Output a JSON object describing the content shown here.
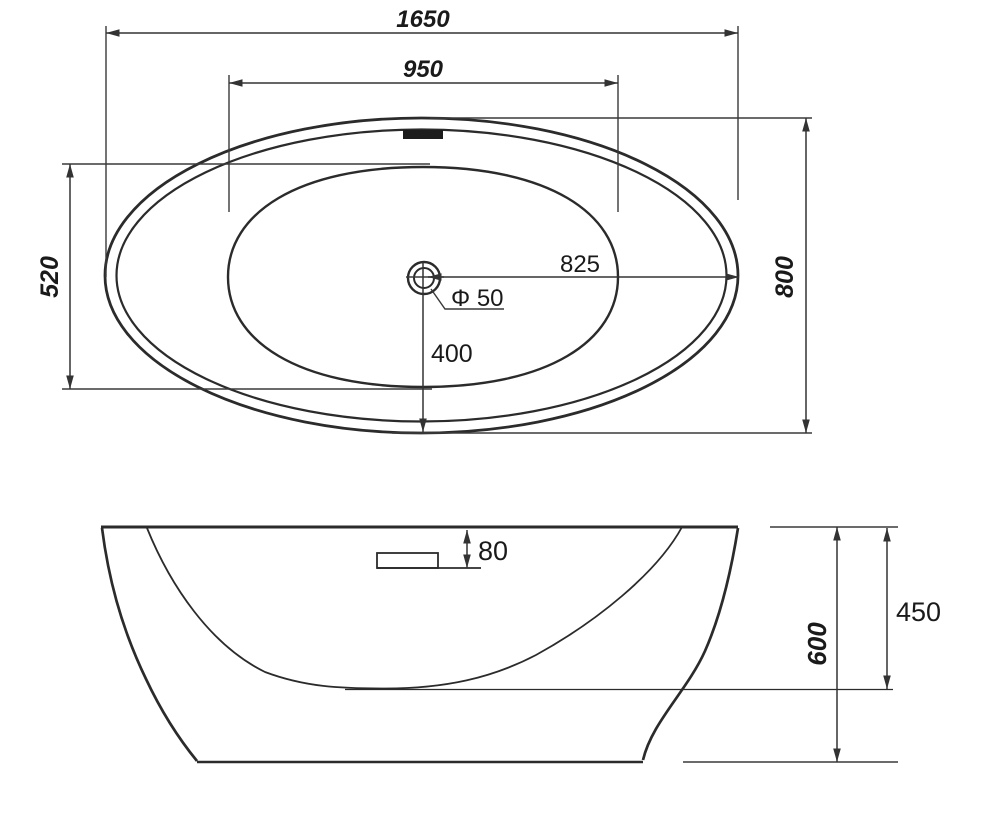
{
  "diagram": {
    "type": "technical-drawing",
    "subject": "Freestanding oval bathtub dimension drawing (plan view and front elevation)",
    "units": "mm",
    "top_view": {
      "labels": {
        "overall_length": "1650",
        "basin_length": "950",
        "basin_width": "520",
        "overall_width": "800",
        "drain_to_right_edge": "825",
        "drain_diameter": "Φ 50",
        "drain_to_front_edge": "400"
      }
    },
    "side_view": {
      "labels": {
        "overflow_below_rim": "80",
        "basin_depth": "450",
        "overall_height": "600"
      }
    },
    "colors": {
      "line": "#2b2b2b",
      "dimension_line": "#333333",
      "background": "#ffffff"
    }
  }
}
